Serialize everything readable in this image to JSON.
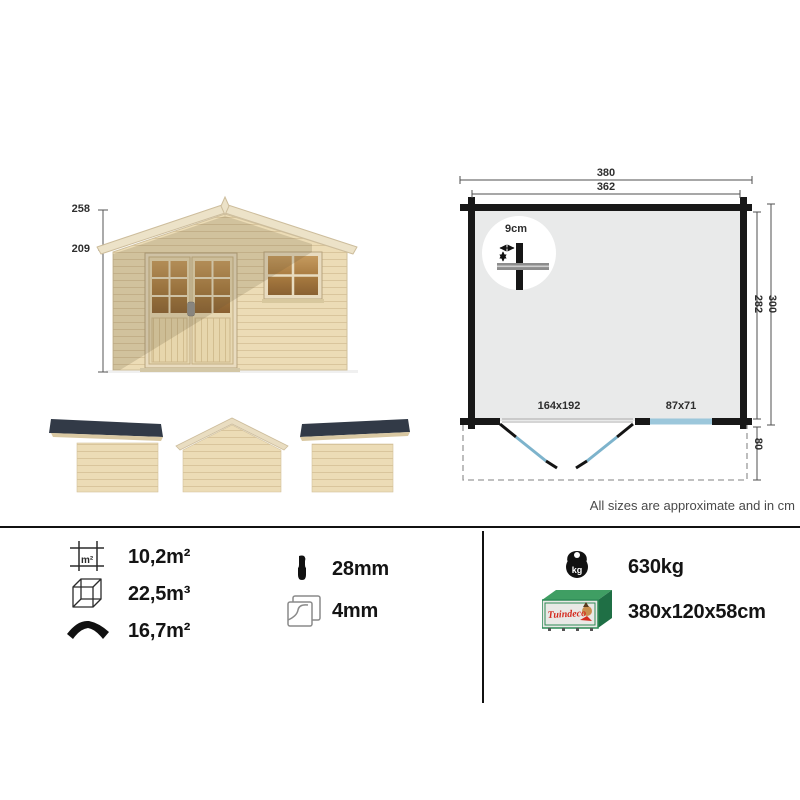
{
  "front_elevation": {
    "peak_height": "258",
    "eaves_height": "209"
  },
  "floor_plan": {
    "outer_width": "380",
    "inner_width": "362",
    "inner_depth": "282",
    "outer_depth": "300",
    "canopy_depth": "80",
    "wall_detail": "9cm",
    "door_size": "164x192",
    "window_size": "87x71"
  },
  "note": "All sizes are approximate and in cm",
  "specs": {
    "floor_area": {
      "value": "10,2m²",
      "unit_label": "m²"
    },
    "volume": {
      "value": "22,5m³"
    },
    "roof_area": {
      "value": "16,7m²"
    },
    "wall_thickness": {
      "value": "28mm"
    },
    "glass_thickness": {
      "value": "4mm"
    },
    "weight": {
      "value": "630kg",
      "unit_label": "kg"
    },
    "package": {
      "value": "380x120x58cm",
      "brand": "Tuindeco"
    }
  },
  "colors": {
    "wood": "#ecdcb6",
    "roof_dark": "#323a47",
    "plan_floor": "#e9eaea",
    "accent_blue": "#7db3cc",
    "brand_green": "#2e8b57",
    "brand_red": "#d42a1e"
  }
}
